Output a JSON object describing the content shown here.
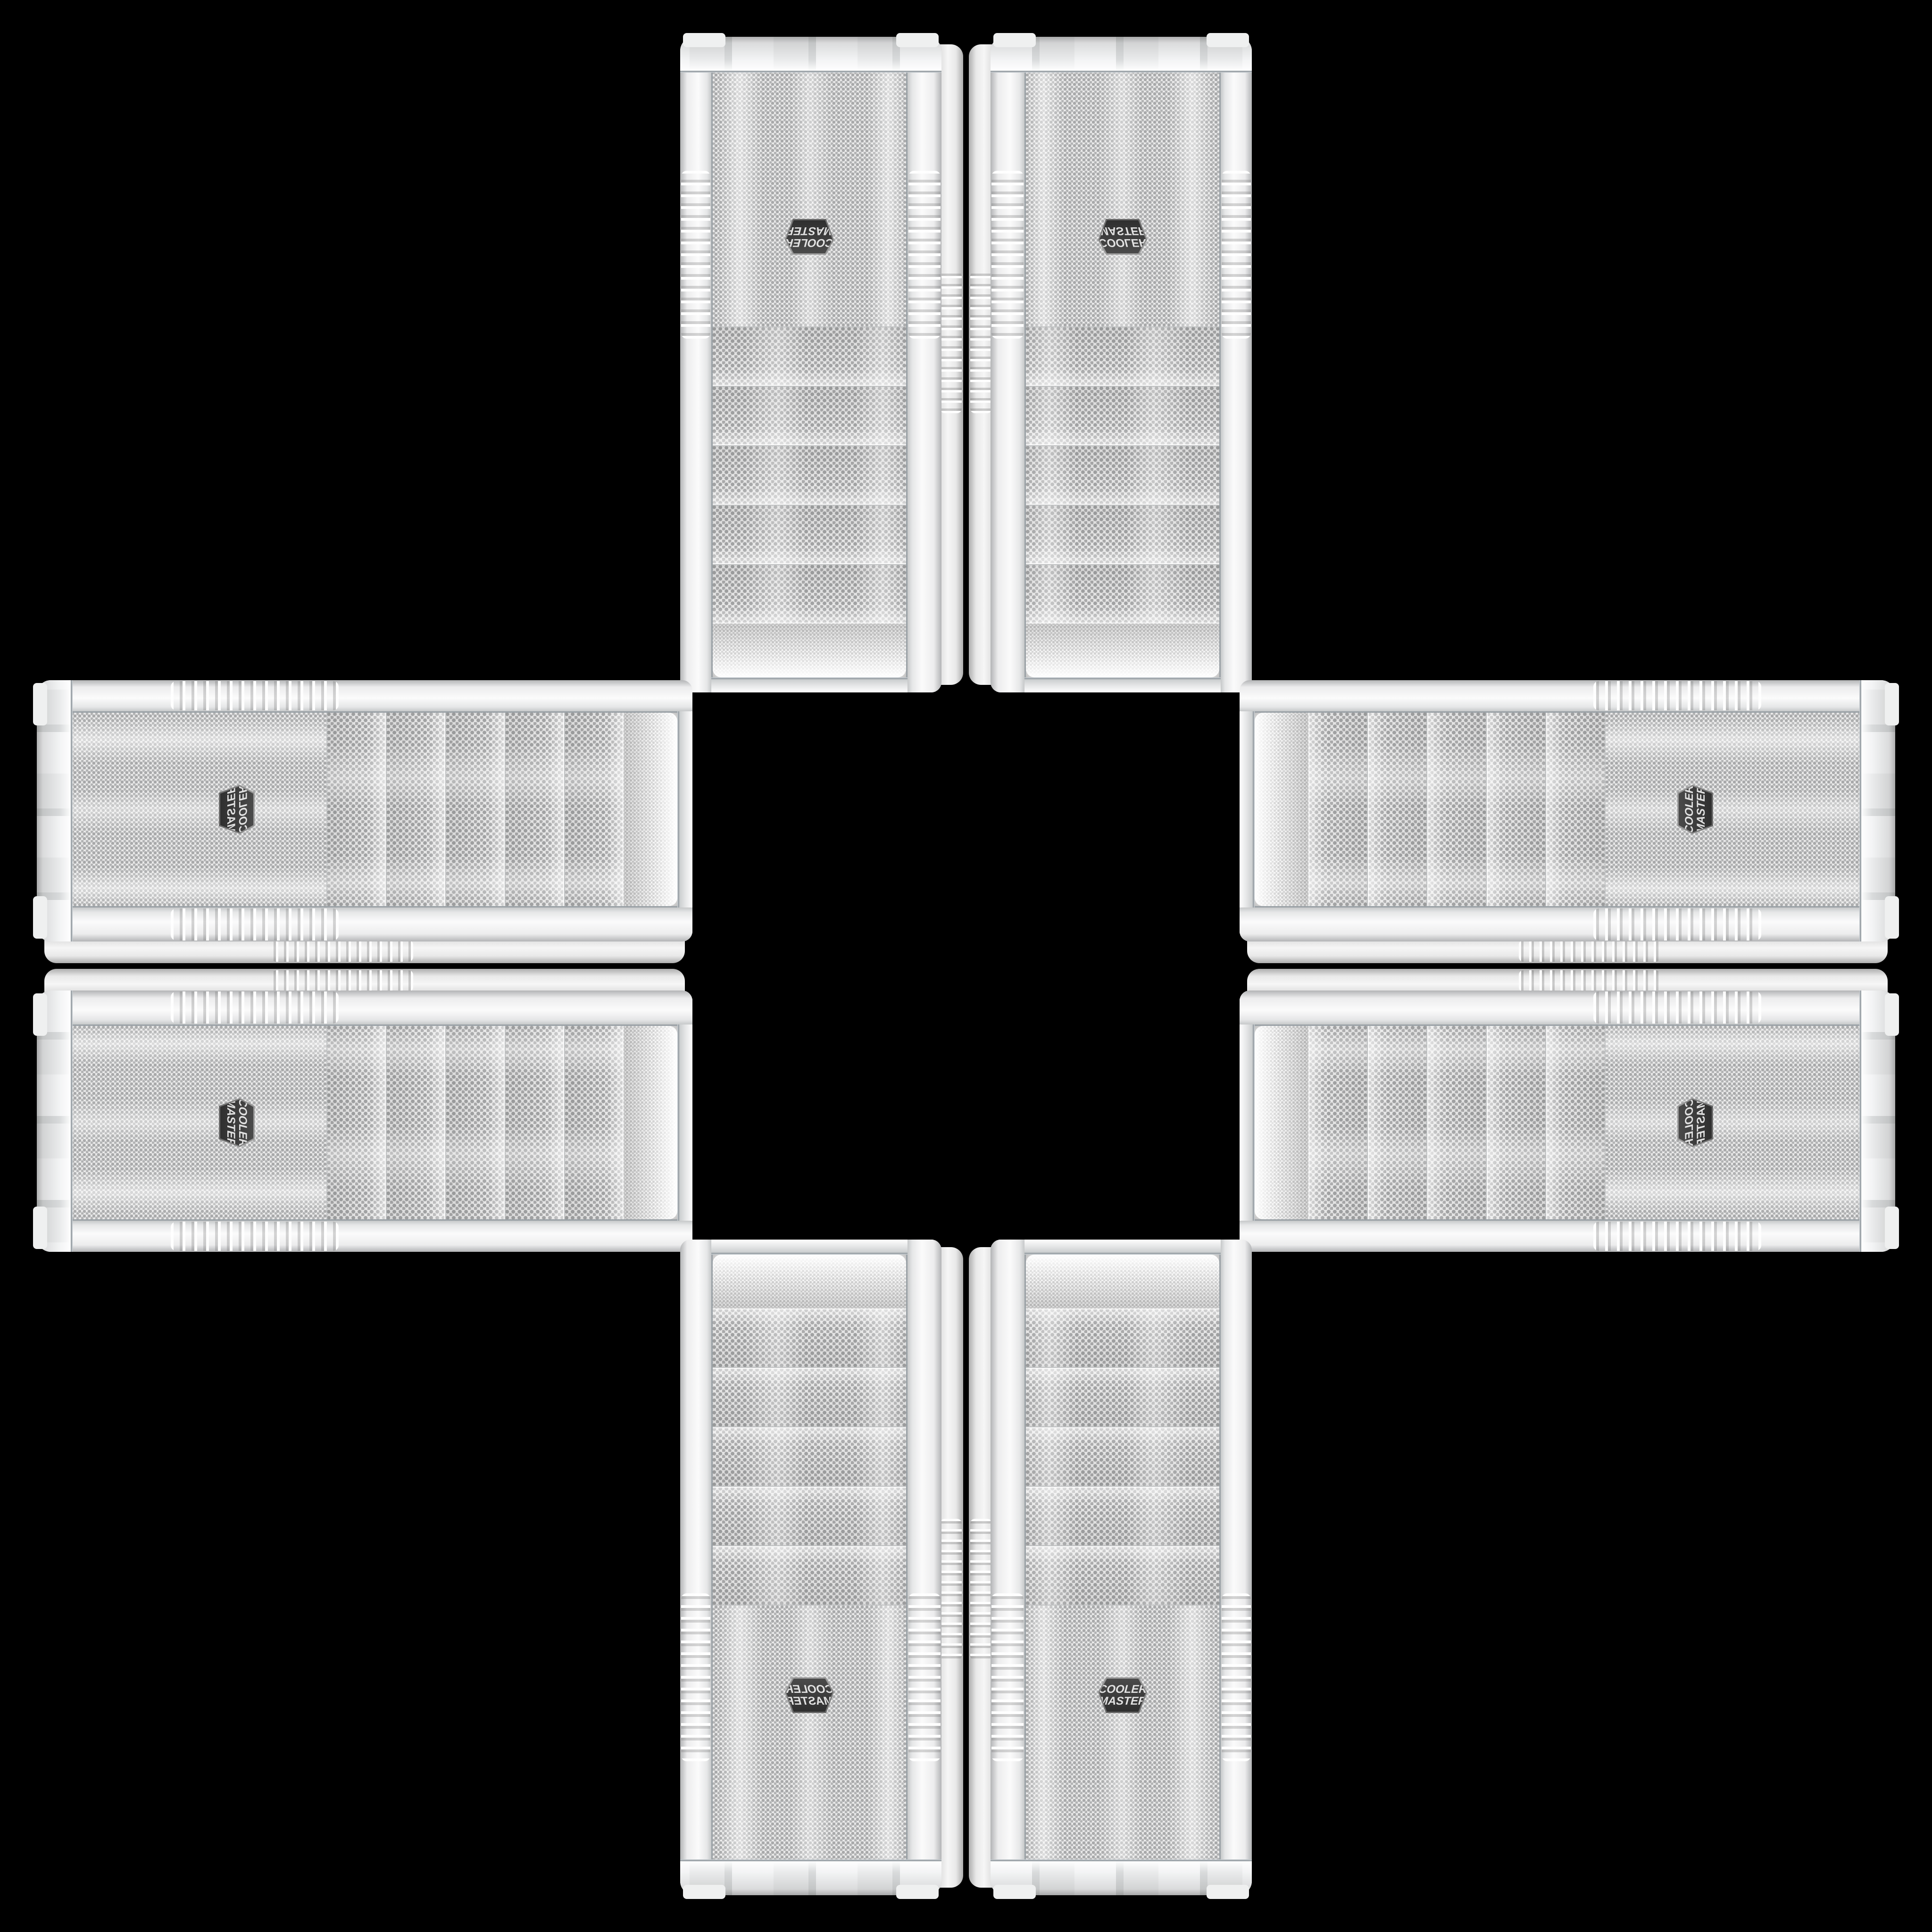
{
  "scene": {
    "background_color": "#000000",
    "description": "Eight identical white Cooler Master PC tower cases arranged in a mirrored cross / plus pattern on a black background"
  },
  "brand": {
    "logo_line1": "COOLER",
    "logo_line2": "MASTER"
  },
  "colors": {
    "background": "#000000",
    "case_body": "#ececec",
    "rail_highlight": "#fbfbfb",
    "mesh_base": "#e8e8e8",
    "mesh_dot": "#a8a9aa",
    "chrome": "#8f969c",
    "badge_bg": "#4a4a4a",
    "badge_text": "#e2e2e2"
  },
  "cases": [
    {
      "id": "top-left",
      "arm": "top",
      "slot": "left",
      "orientation": "rotated-180"
    },
    {
      "id": "top-right",
      "arm": "top",
      "slot": "right",
      "orientation": "flipped-vertical"
    },
    {
      "id": "left-top",
      "arm": "left",
      "slot": "top",
      "orientation": "rotated-90-cw-flipped"
    },
    {
      "id": "left-bottom",
      "arm": "left",
      "slot": "bottom",
      "orientation": "rotated-90-cw"
    },
    {
      "id": "right-top",
      "arm": "right",
      "slot": "top",
      "orientation": "rotated-90-ccw"
    },
    {
      "id": "right-bottom",
      "arm": "right",
      "slot": "bottom",
      "orientation": "rotated-90-cw-mirrored"
    },
    {
      "id": "bottom-left",
      "arm": "bottom",
      "slot": "left",
      "orientation": "mirrored-horizontal"
    },
    {
      "id": "bottom-right",
      "arm": "bottom",
      "slot": "right",
      "orientation": "original"
    }
  ]
}
